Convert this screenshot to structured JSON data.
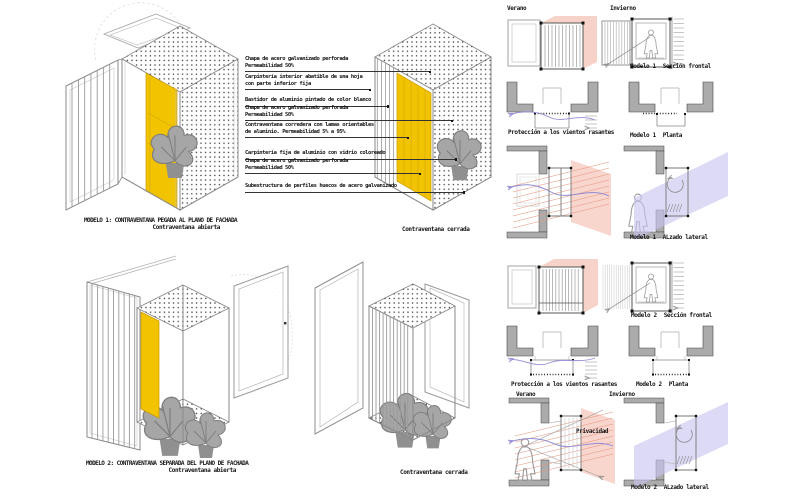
{
  "colors": {
    "accent_yellow": "#F2C300",
    "shadow_pink": "#F7D2C9",
    "sun_ray_red": "#E4967F",
    "shadow_blue": "#C8C4F1",
    "wall_gray": "#ABABAB",
    "line_gray": "#8A8A8A"
  },
  "model1": {
    "title": "MODELO 1: CONTRAVENTANA PEGADA AL PLANO DE FACHADA",
    "open_caption": "Contraventana abierta",
    "closed_caption": "Contraventana cerrada"
  },
  "model2": {
    "title": "MODELO 2: CONTRAVENTANA SEPARADA DEL PLANO DE FACHADA",
    "open_caption": "Contraventana abierta",
    "closed_caption": "Contraventana cerrada"
  },
  "annotations": [
    {
      "line1": "Chapa de acero galvanizado perforada",
      "line2": "Permeabilidad 50%"
    },
    {
      "line1": "Carpintería interior abatible de una hoja",
      "line2": "con parte inferior fija"
    },
    {
      "line1": "Bastidor de aluminio pintado de color blanco",
      "line2": ""
    },
    {
      "line1": "Chapa de acero galvanizado perforada",
      "line2": "Permeabilidad 50%"
    },
    {
      "line1": "Contraventana corredera con lamas orientables",
      "line2": "de aluminio. Permeabilidad 5% a 95%"
    },
    {
      "line1": "Carpintería fija de aluminio con vidrio coloreado",
      "line2": ""
    },
    {
      "line1": "Chapa de acero galvanizado perforada",
      "line2": "Permeabilidad 50%"
    },
    {
      "line1": "Subestructura de perfiles huecos de acero galvanizado",
      "line2": ""
    }
  ],
  "right_panel": {
    "season_summer": "Verano",
    "season_winter": "Invierno",
    "wind_protection": "Protección a los vientos rasantes",
    "privacy": "Privacidad",
    "captions": {
      "m1_section": {
        "model": "Modelo 1",
        "view": "Sección frontal"
      },
      "m1_plan": {
        "model": "Modelo 1",
        "view": "Planta"
      },
      "m1_side": {
        "model": "Modelo 1",
        "view": "ALzado lateral"
      },
      "m2_section": {
        "model": "Modelo 2",
        "view": "Sección frontal"
      },
      "m2_plan": {
        "model": "Modelo 2",
        "view": "Planta"
      },
      "m2_side": {
        "model": "Modelo 2",
        "view": "ALzado lateral"
      }
    }
  }
}
